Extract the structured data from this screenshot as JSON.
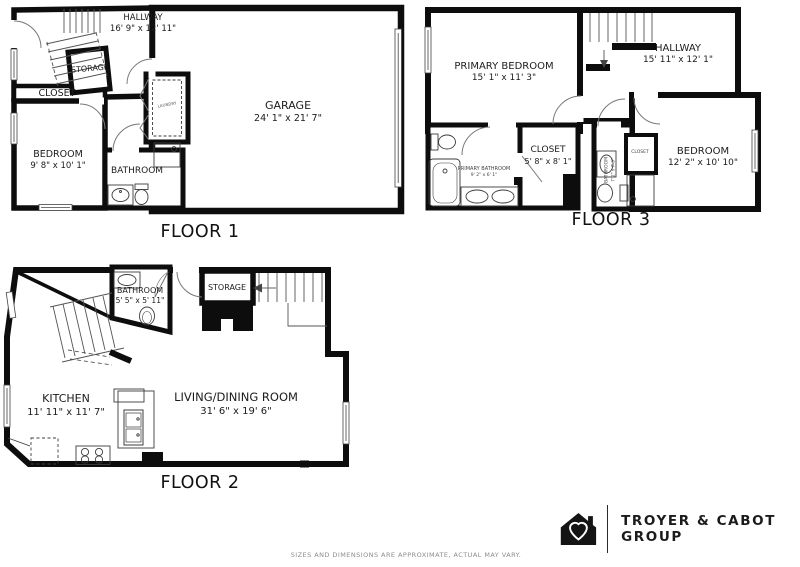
{
  "floors": {
    "floor1": {
      "title": "FLOOR 1",
      "rooms": {
        "hallway": {
          "name": "HALLWAY",
          "dims": "16' 9\" x 12' 11\""
        },
        "storage": {
          "name": "STORAGE"
        },
        "closet": {
          "name": "CLOSET"
        },
        "bedroom": {
          "name": "BEDROOM",
          "dims": "9' 8\" x 10' 1\""
        },
        "bathroom": {
          "name": "BATHROOM"
        },
        "laundry": {
          "name": "LAUNDRY"
        },
        "garage": {
          "name": "GARAGE",
          "dims": "24' 1\" x 21' 7\""
        }
      }
    },
    "floor2": {
      "title": "FLOOR 2",
      "rooms": {
        "bathroom": {
          "name": "BATHROOM",
          "dims": "5' 5\" x 5' 11\""
        },
        "storage": {
          "name": "STORAGE"
        },
        "kitchen": {
          "name": "KITCHEN",
          "dims": "11' 11\" x 11' 7\""
        },
        "living": {
          "name": "LIVING/DINING ROOM",
          "dims": "31' 6\" x 19' 6\""
        }
      }
    },
    "floor3": {
      "title": "FLOOR 3",
      "rooms": {
        "primary_bedroom": {
          "name": "PRIMARY BEDROOM",
          "dims": "15' 1\" x 11' 3\""
        },
        "hallway": {
          "name": "HALLWAY",
          "dims": "15' 11\" x 12' 1\""
        },
        "closet": {
          "name": "CLOSET",
          "dims": "5' 8\" x 8' 1\""
        },
        "primary_bathroom": {
          "name": "PRIMARY BATHROOM",
          "dims": "9' 2\" x 6' 1\""
        },
        "bathroom": {
          "name": "BATHROOM",
          "dims": "7' 2\" x 7' 3\""
        },
        "closet_small": {
          "name": "CLOSET"
        },
        "bedroom": {
          "name": "BEDROOM",
          "dims": "12' 2\" x 10' 10\""
        }
      }
    }
  },
  "brand": {
    "name": "TROYER & CABOT GROUP"
  },
  "disclaimer": "SIZES AND DIMENSIONS ARE APPROXIMATE, ACTUAL MAY VARY.",
  "colors": {
    "wall": "#0d0d0d",
    "thin_line": "#3c3c3c",
    "text": "#1c1c1c"
  }
}
